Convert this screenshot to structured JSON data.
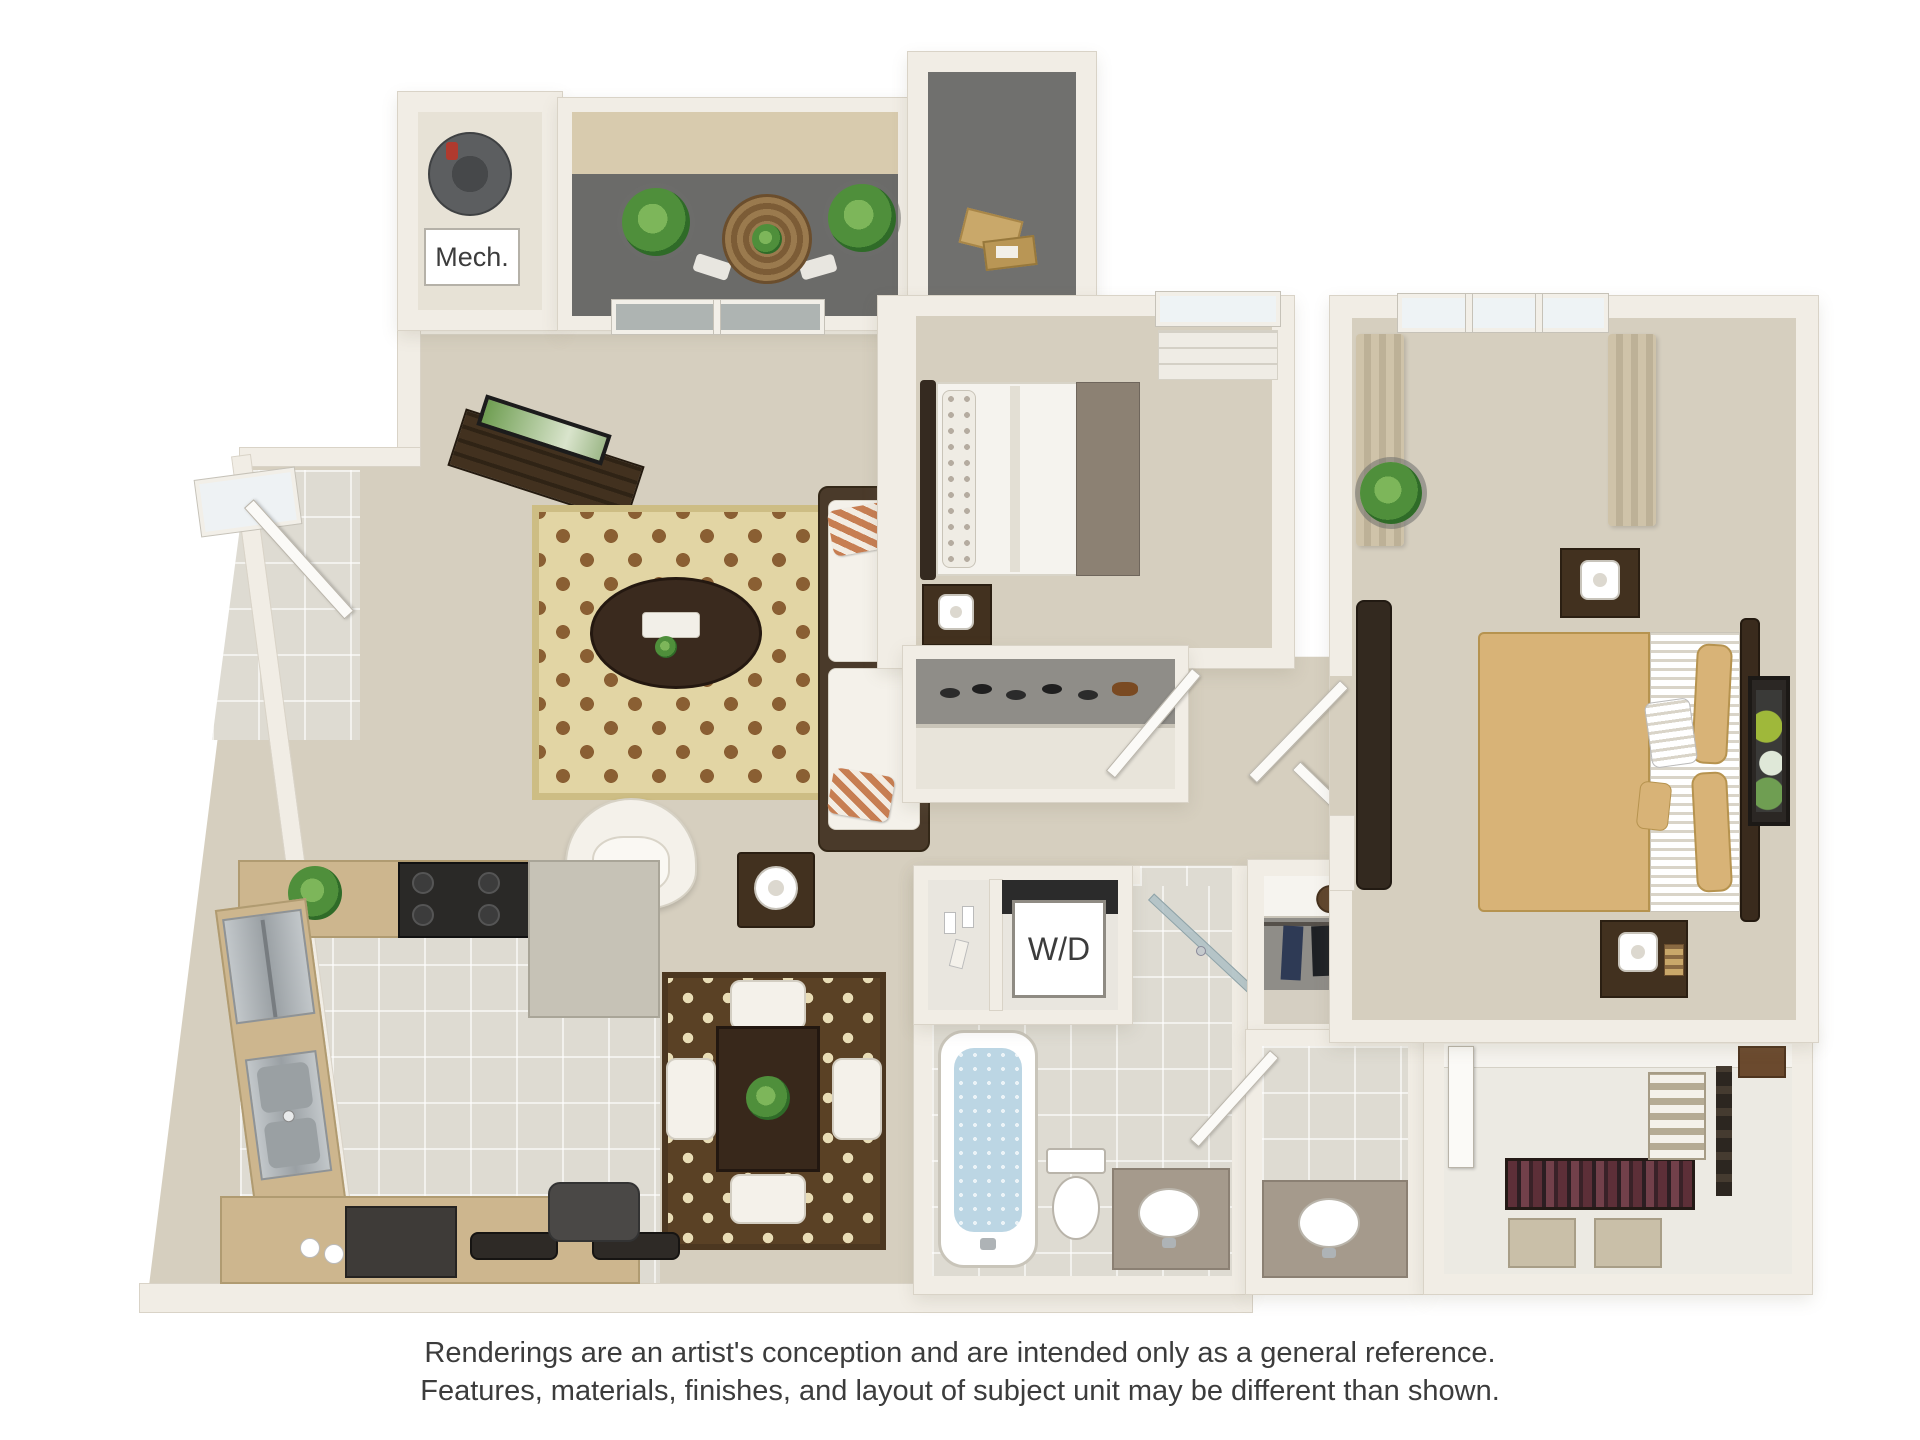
{
  "labels": {
    "mech": "Mech.",
    "washer_dryer": "W/D"
  },
  "disclaimer": {
    "line1": "Renderings are an artist's conception and are intended only as a general reference.",
    "line2": "Features, materials, finishes, and layout of subject unit may be different than shown."
  },
  "colors": {
    "wall": "#f1ede5",
    "wall_line": "#d9d3c7",
    "carpet": "#d6cfbf",
    "tile": "#dedbd2",
    "balcony_floor": "#6b6b69",
    "privacy_wall": "#d8cbae",
    "storage_floor": "#70706e",
    "cabinet": "#cdb68e",
    "counter_gray": "#c6c2b6",
    "appliance_dark": "#2a2927",
    "wood_dark": "#42311f",
    "rug_living_bg": "#e2d5a4",
    "rug_living_pat": "#8a5f33",
    "rug_dining_bg": "#5a4125",
    "rug_dining_pat": "#e9ddb6",
    "fabric_white": "#f4f1ea",
    "pillow_orange": "#c77e52",
    "blanket_taupe": "#8c8173",
    "comforter_tan": "#d8b377",
    "water_blue": "#bcd6e4",
    "vanity_taupe": "#a59a8c",
    "plant_green": "#4f8f3b",
    "plant_dark": "#2f6b28",
    "glass": "#aeb4b2",
    "shade": "#efece5",
    "closet_back": "#8f8d88",
    "text_dark": "#3c3c3c"
  }
}
